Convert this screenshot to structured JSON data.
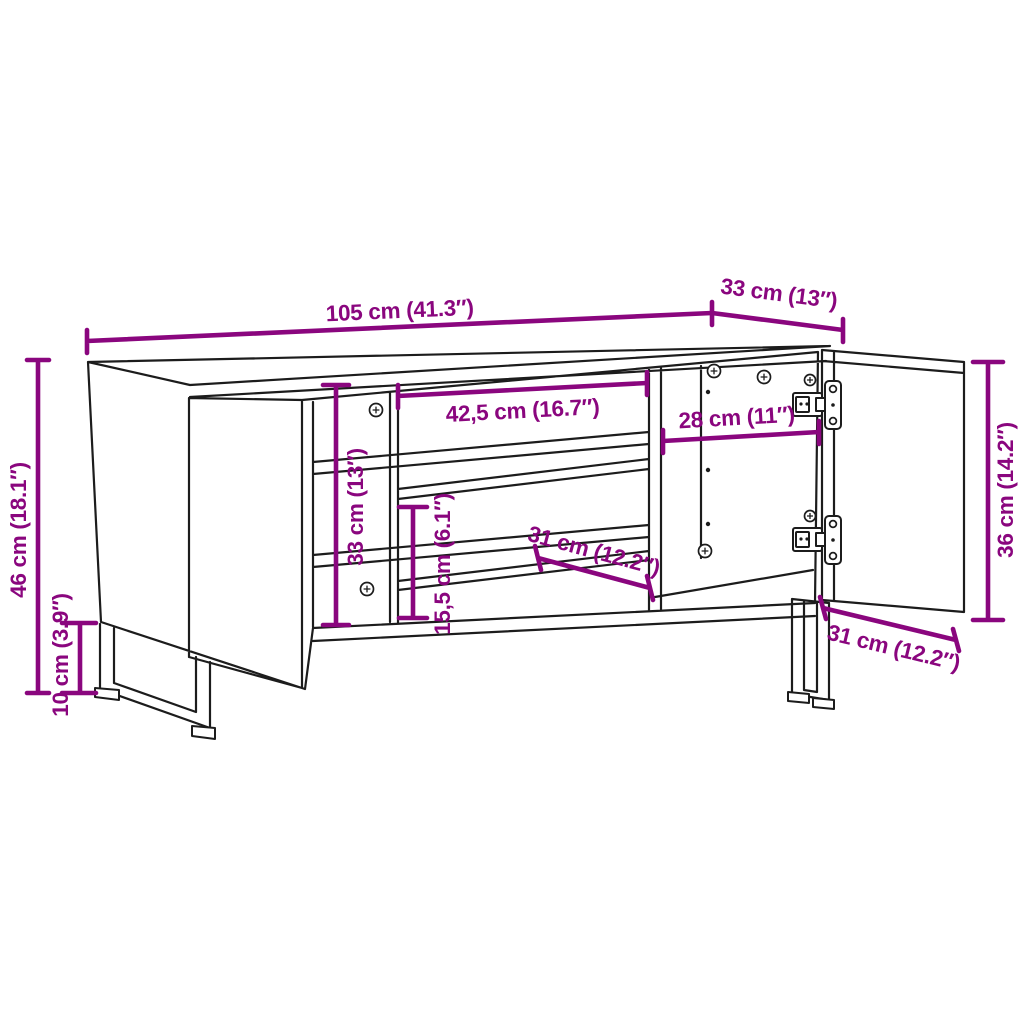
{
  "diagram": {
    "subject": "tv-cabinet-dimension-drawing",
    "colors": {
      "dimension": "#8A067E",
      "line": "#1c1c1c",
      "background": "#ffffff"
    },
    "dims": {
      "overall_width": "105 cm (41.3″)",
      "overall_depth": "33 cm (13″)",
      "overall_height": "46 cm (18.1″)",
      "leg_height": "10 cm (3.9″)",
      "interior_height": "33 cm (13″)",
      "middle_compartment_width": "42,5 cm (16.7″)",
      "right_compartment_width": "28 cm (11″)",
      "lower_compartment_height": "15,5 cm (6.1″)",
      "shelf_depth": "31 cm (12.2″)",
      "door_height": "36 cm (14.2″)",
      "door_width": "31 cm (12.2″)"
    }
  }
}
